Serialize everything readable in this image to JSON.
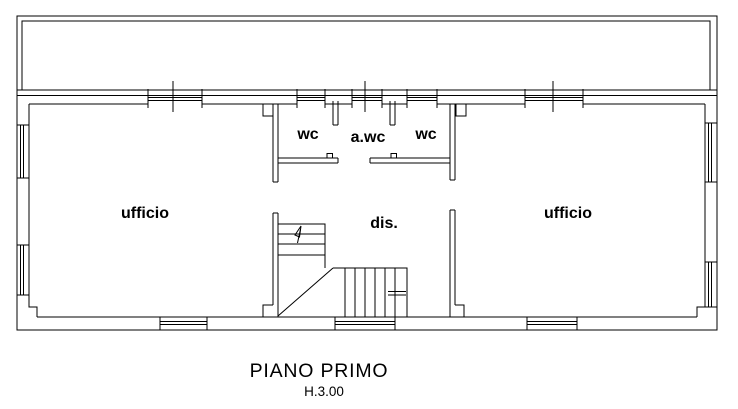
{
  "colors": {
    "background": "#ffffff",
    "line": "#000000"
  },
  "plan": {
    "rooms": [
      {
        "name": "wc-left",
        "label": "wc"
      },
      {
        "name": "anti-wc",
        "label": "a.wc"
      },
      {
        "name": "wc-right",
        "label": "wc"
      },
      {
        "name": "ufficio-left",
        "label": "ufficio"
      },
      {
        "name": "disimpegno",
        "label": "dis."
      },
      {
        "name": "ufficio-right",
        "label": "ufficio"
      }
    ],
    "caption": {
      "title": "PIANO PRIMO",
      "height_note": "H.3.00"
    }
  }
}
